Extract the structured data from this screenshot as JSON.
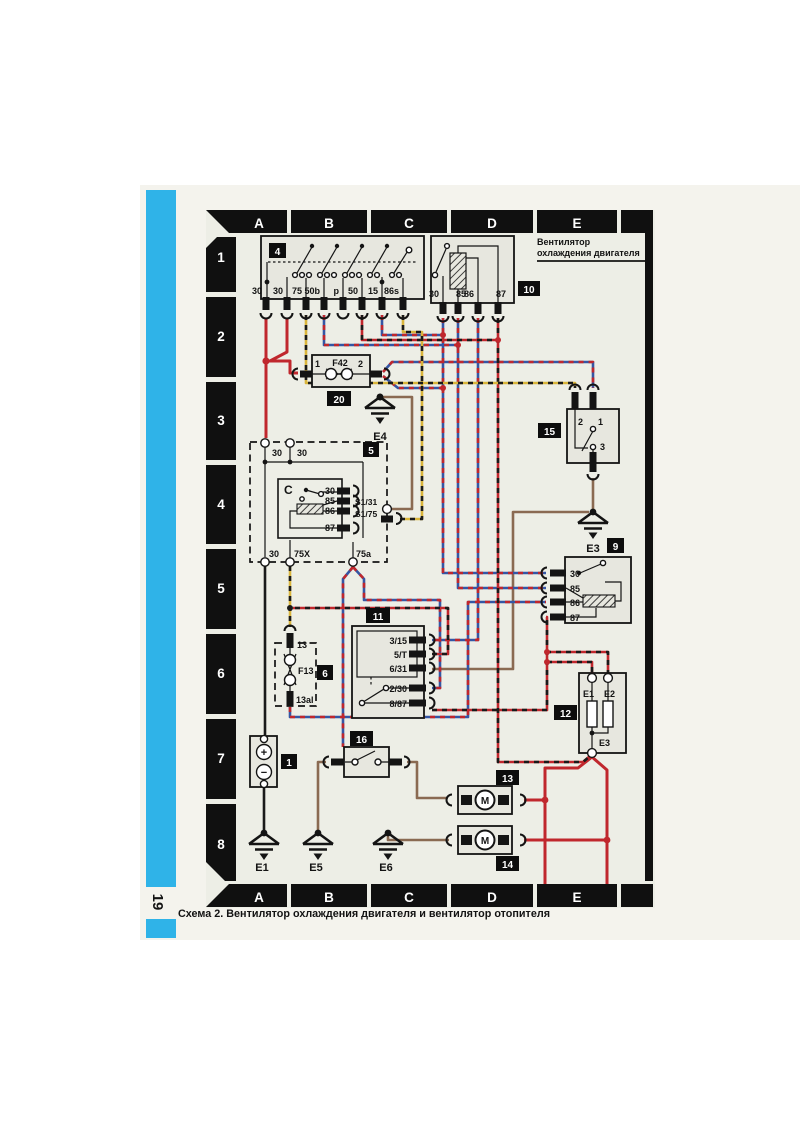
{
  "page": {
    "number": "19",
    "caption": "Схема 2. Вентилятор охлаждения двигателя и вентилятор отопителя"
  },
  "grid": {
    "cols": [
      "A",
      "B",
      "C",
      "D",
      "E"
    ],
    "rows": [
      "1",
      "2",
      "3",
      "4",
      "5",
      "6",
      "7",
      "8"
    ]
  },
  "annotation": {
    "line1": "Вентилятор",
    "line2": "охлаждения двигателя"
  },
  "c4": {
    "badge": "4",
    "terminals": [
      "30",
      "30",
      "75",
      "50b",
      "p",
      "50",
      "15",
      "86s"
    ]
  },
  "c10": {
    "badge": "10",
    "terminals": [
      "30",
      "85",
      "86",
      "87"
    ]
  },
  "f42": {
    "badge": "20",
    "name": "F42",
    "pin1": "1",
    "pin2": "2"
  },
  "c5": {
    "badge": "5",
    "letter": "C",
    "top1": "30",
    "top2": "30",
    "terminals": [
      "30",
      "85",
      "86",
      "87"
    ],
    "link1": "S1/31",
    "link2": "S1/75",
    "bottom": [
      "30",
      "75X",
      "75a"
    ]
  },
  "c15": {
    "badge": "15",
    "pin1": "1",
    "pin2": "2",
    "pin3": "3"
  },
  "c9": {
    "badge": "9",
    "terminals": [
      "30",
      "85",
      "86",
      "87"
    ]
  },
  "c11": {
    "badge": "11",
    "terminals": [
      "3/15",
      "5/T",
      "6/31",
      "2/30",
      "8/87"
    ]
  },
  "c6": {
    "badge": "6",
    "fuse": "F13",
    "top": "13",
    "bottom": "13al"
  },
  "c16": {
    "badge": "16"
  },
  "c1": {
    "badge": "1",
    "plus": "+",
    "minus": "−"
  },
  "c12": {
    "badge": "12",
    "e1": "E1",
    "e2": "E2",
    "e3": "E3"
  },
  "c13": {
    "badge": "13",
    "motor": "M"
  },
  "c14": {
    "badge": "14",
    "motor": "M"
  },
  "grounds": {
    "e1": "E1",
    "e3": "E3",
    "e4": "E4",
    "e5": "E5",
    "e6": "E6"
  },
  "colors": {
    "red": "#c0272d",
    "blue": "#3556a4",
    "yellow": "#d9b53c",
    "brown": "#8a6a52",
    "black": "#1a1a1a",
    "cyan_stripe": "#2fb3e8",
    "frame": "#101010",
    "box_fill": "#e7e7df",
    "page_bg": "#f4f3ed",
    "diagram_bg": "#edeee6"
  }
}
